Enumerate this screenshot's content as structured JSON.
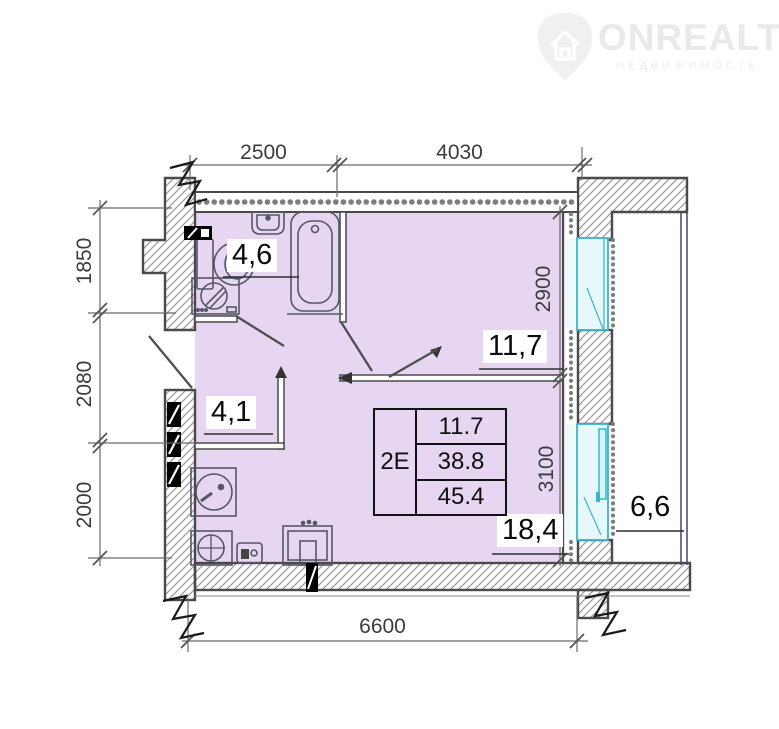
{
  "logo": {
    "brand": "ONREALT",
    "tagline": "НЕДВИЖИМОСТЬ"
  },
  "plan": {
    "rooms": [
      {
        "name": "bathroom",
        "area": "4,6"
      },
      {
        "name": "hallway",
        "area": "4,1"
      },
      {
        "name": "room",
        "area": "11,7"
      },
      {
        "name": "kitchen-living-room",
        "area": "18,4"
      },
      {
        "name": "balcony",
        "area": "6,6"
      }
    ],
    "table": {
      "unit_label": "2Е",
      "rows": [
        "11.7",
        "38.8",
        "45.4"
      ]
    },
    "dimensions": {
      "top": [
        "2500",
        "4030"
      ],
      "left": [
        "1850",
        "2080",
        "2000"
      ],
      "right": [
        "2900",
        "3100"
      ],
      "bottom": [
        "6600"
      ]
    },
    "colors": {
      "room_fill": "#e6d6f2",
      "wall_stroke": "#4a4a4a",
      "window": "#3ab5c9",
      "railing": "#46466e",
      "dim_text": "#3c3c3c"
    }
  }
}
